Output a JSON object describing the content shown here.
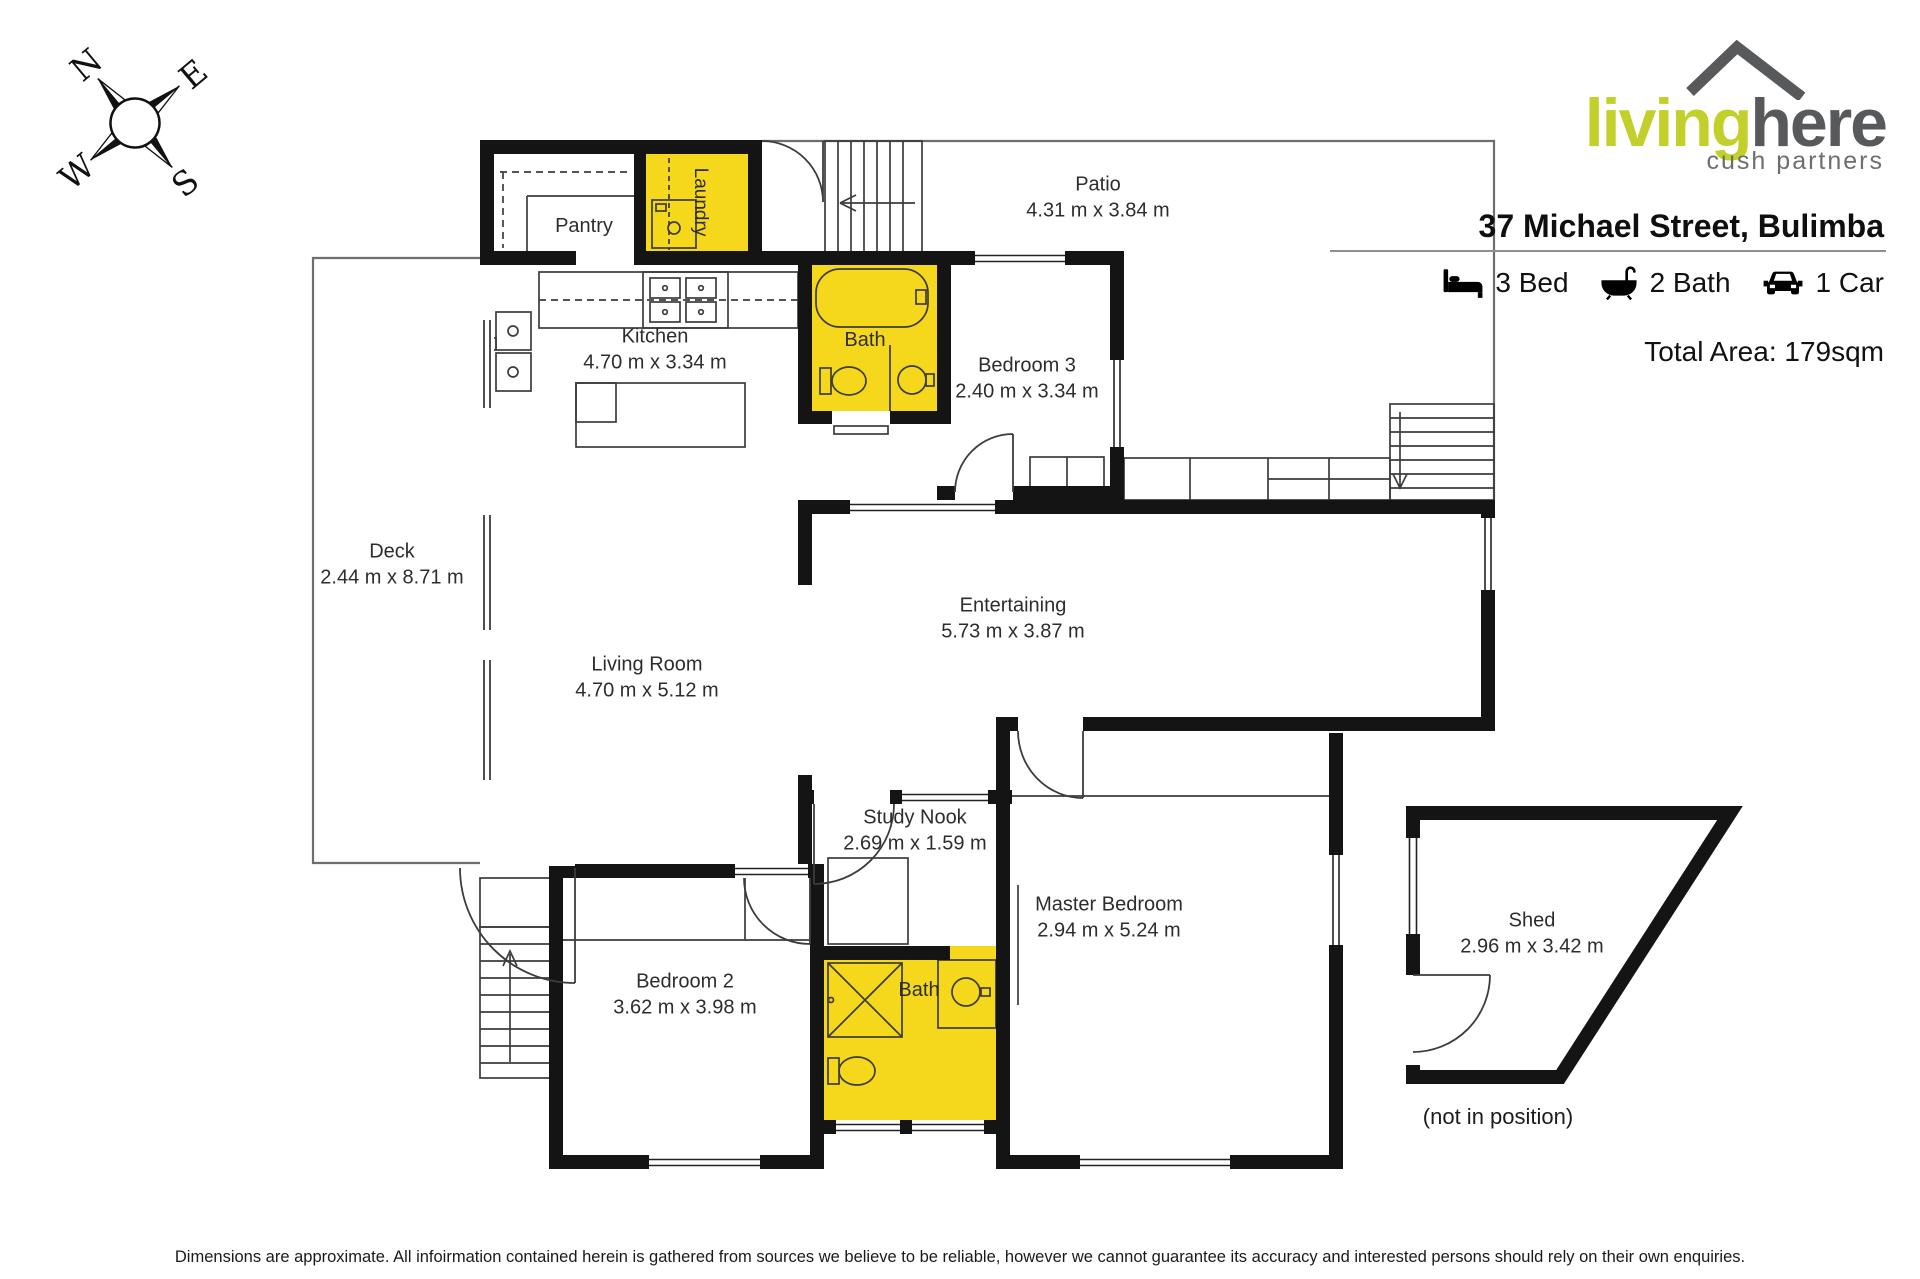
{
  "colors": {
    "accent_yellow": "#F5D81B",
    "brand_green": "#C3D02B",
    "brand_gray": "#58595B"
  },
  "compass": {
    "north": "N",
    "east": "E",
    "south": "S",
    "west": "W"
  },
  "logo": {
    "brand_primary": "living",
    "brand_secondary": "here",
    "tagline": "cush partners"
  },
  "header": {
    "address": "37 Michael Street, Bulimba",
    "features": [
      {
        "icon": "bed-icon",
        "label": "3 Bed"
      },
      {
        "icon": "bath-icon",
        "label": "2 Bath"
      },
      {
        "icon": "car-icon",
        "label": "1 Car"
      }
    ],
    "total_area": "Total Area: 179sqm"
  },
  "rooms": [
    {
      "name": "Pantry",
      "dims": ""
    },
    {
      "name": "Laundry",
      "dims": ""
    },
    {
      "name": "Patio",
      "dims": "4.31 m x 3.84 m"
    },
    {
      "name": "Kitchen",
      "dims": "4.70 m x 3.34 m"
    },
    {
      "name": "Bath",
      "dims": ""
    },
    {
      "name": "Bedroom 3",
      "dims": "2.40 m x 3.34 m"
    },
    {
      "name": "Deck",
      "dims": "2.44 m x 8.71 m"
    },
    {
      "name": "Entertaining",
      "dims": "5.73 m x 3.87 m"
    },
    {
      "name": "Living Room",
      "dims": "4.70 m x 5.12 m"
    },
    {
      "name": "Study Nook",
      "dims": "2.69 m x 1.59 m"
    },
    {
      "name": "Master Bedroom",
      "dims": "2.94 m x 5.24 m"
    },
    {
      "name": "Bedroom 2",
      "dims": "3.62 m x 3.98 m"
    },
    {
      "name": "Bath",
      "dims": ""
    },
    {
      "name": "Shed",
      "dims": "2.96 m x 3.42 m"
    }
  ],
  "shed_note": "(not in position)",
  "disclaimer": "Dimensions are approximate. All infoirmation contained herein is gathered from sources we believe to be reliable, however we cannot guarantee its accuracy and interested persons should rely on their own enquiries."
}
